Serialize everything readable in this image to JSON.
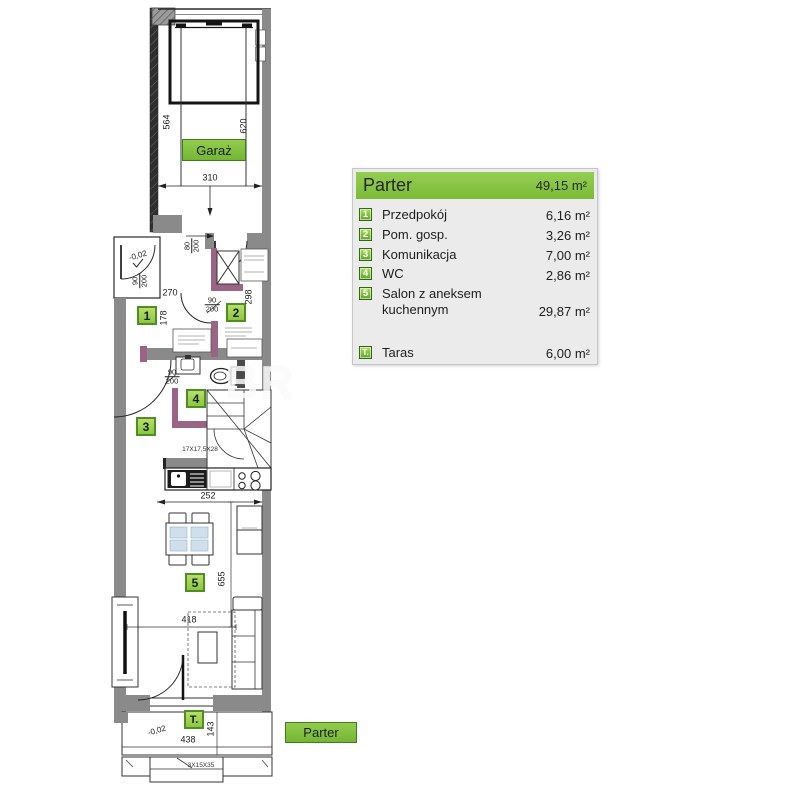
{
  "legend": {
    "title": "Parter",
    "total_area": "49,15 m²",
    "rows": [
      {
        "badge": "1",
        "name": "Przedpokój",
        "area": "6,16 m²"
      },
      {
        "badge": "2",
        "name": "Pom. gosp.",
        "area": "3,26 m²"
      },
      {
        "badge": "3",
        "name": "Komunikacja",
        "area": "7,00 m²"
      },
      {
        "badge": "4",
        "name": "WC",
        "area": "2,86 m²"
      },
      {
        "badge": "5",
        "name": "Salon z aneksem kuchennym",
        "area": "29,87 m²"
      }
    ],
    "terrace": {
      "badge": "T.",
      "name": "Taras",
      "area": "6,00 m²"
    }
  },
  "plan": {
    "garage_label": "Garaż",
    "floor_label": "Parter",
    "badges": {
      "b1": "1",
      "b2": "2",
      "b3": "3",
      "b4": "4",
      "b5": "5",
      "bt": "T."
    },
    "dims": {
      "d564": "564",
      "d620": "620",
      "d310": "310",
      "d270": "270",
      "d178": "178",
      "d298": "298",
      "d252": "252",
      "d655": "655",
      "d418": "418",
      "d438": "438",
      "d143": "143"
    },
    "door_sizes": {
      "f80": {
        "w": "80",
        "h": "200"
      },
      "f90a": {
        "w": "90",
        "h": "200"
      },
      "f90b": {
        "w": "90",
        "h": "200"
      },
      "f90c": {
        "w": "90",
        "h": "200"
      }
    },
    "levels": {
      "entry": "-0,02",
      "terrace": "-0,02"
    },
    "stair_note": "17X17,5X28",
    "steps_note": "3X15X35",
    "watermark": "BR"
  },
  "colors": {
    "accent_green": "#7dc242",
    "badge_green_dark": "#4f8e22",
    "wall_gray": "#8a8a8a",
    "accent_purple": "#9c6484",
    "table_blue": "#cfdfeb"
  }
}
